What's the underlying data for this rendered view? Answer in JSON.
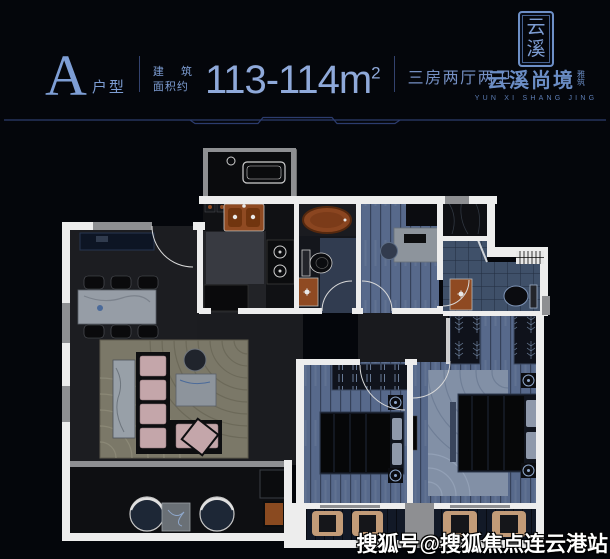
{
  "header": {
    "plan_letter": "A",
    "plan_letter_label": "户型",
    "area_label_line1": "建 筑",
    "area_label_line2": "面积约",
    "area_value": "113-114m",
    "area_unit_sup": "2",
    "rooms_summary": "三房两厅两卫"
  },
  "logo": {
    "seal_char_top": "云",
    "seal_char_bottom": "溪",
    "name_cn": "云溪尚境",
    "name_suffix_top": "雅",
    "name_suffix_bottom": "筑",
    "name_en": "YUN XI SHANG JING"
  },
  "watermark": {
    "text": "搜狐号@搜狐焦点连云港站"
  },
  "colors": {
    "background": "#04060b",
    "accent_blue": "#7d9dd3",
    "area_value_blue": "#8fa9da",
    "logo_blue": "#6b8dc5",
    "divider_navy": "#2c3c6e",
    "wall_white": "#ededed",
    "wall_gray": "#8e8f92",
    "floor_dark": "#1c1d21",
    "wood_blue": "#57698b",
    "bath_tile_blue": "#3f5069",
    "rug_olive": "#7b7868",
    "sofa_pink": "#c4a6aa",
    "fixture_brown": "#8f4a22",
    "tub_brown": "#8a4520",
    "cushion_tan": "#c29b78",
    "watermark_white": "#ffffff"
  }
}
